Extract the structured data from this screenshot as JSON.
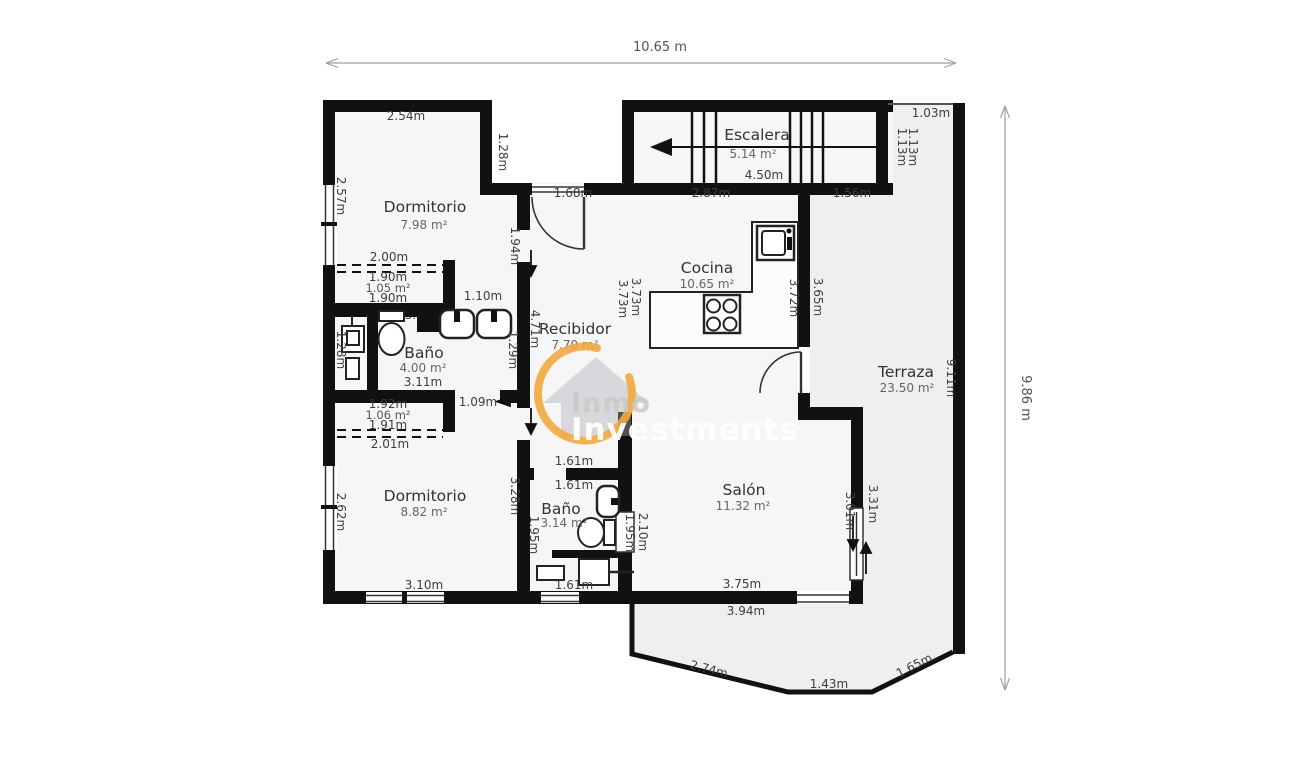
{
  "colors": {
    "wall": "#111111",
    "room_fill": "#f6f6f6",
    "terrace_fill": "#efefef",
    "watermark_orange": "#f3a93c",
    "dim_text": "#3d3d3d"
  },
  "overall": {
    "width_label": "10.65 m",
    "height_label": "9.86 m"
  },
  "watermark": {
    "brand_line1": "Inmo",
    "brand_line2": "Investments"
  },
  "rooms": {
    "dormitorio1": {
      "name": "Dormitorio",
      "area": "7.98 m²"
    },
    "armario1": {
      "area": "1.05 m²"
    },
    "banyo1": {
      "name": "Baño",
      "area": "4.00 m²"
    },
    "armario2": {
      "area": "1.06 m²"
    },
    "dormitorio2": {
      "name": "Dormitorio",
      "area": "8.82 m²"
    },
    "banyo2": {
      "name": "Baño",
      "area": "3.14 m²"
    },
    "recibidor": {
      "name": "Recibidor",
      "area": "7.70 m²"
    },
    "escalera": {
      "name": "Escalera",
      "area": "5.14 m²"
    },
    "cocina": {
      "name": "Cocina",
      "area": "10.65 m²"
    },
    "salon": {
      "name": "Salón",
      "area": "11.32 m²"
    },
    "terraza": {
      "name": "Terraza",
      "area": "23.50 m²"
    }
  },
  "dims": {
    "dorm1_top": "2.54m",
    "dorm1_step": "1.28m",
    "dorm1_left": "2.57m",
    "dorm1_right": "1.94m",
    "entry_door": "1.68m",
    "escalera_len": "4.50m",
    "notch_top": "1.03m",
    "notch_a": "1.13m",
    "notch_b": "1.13m",
    "cocina_top": "2.87m",
    "terraza_top": "1.56m",
    "armario1_top": "2.00m",
    "armario1_w1": "1.90m",
    "armario1_w2": "1.90m",
    "banyo1_door": "1.10m",
    "banyo1_top": "3.10m",
    "banyo1_bottom": "3.11m",
    "banyo1_left": "1.28m",
    "banyo1_right": "1.29m",
    "recibidor_left": "4.71m",
    "recibidor_a": "3.73m",
    "recibidor_b": "3.73m",
    "cocina_left": "3.72m",
    "cocina_right": "3.65m",
    "terraza_right": "9.11m",
    "armario2_top": "1.92m",
    "armario2_w": "1.91m",
    "armario2_bottom": "2.01m",
    "dorm2_door": "1.09m",
    "dorm2_left": "2.62m",
    "dorm2_right": "3.28m",
    "dorm2_bottom": "3.10m",
    "recibidor_bottom": "1.61m",
    "banyo2_top": "1.61m",
    "banyo2_left": "1.95m",
    "banyo2_right": "1.95m",
    "banyo2_bottom": "1.61m",
    "salon_left": "2.10m",
    "salon_bottom": "3.75m",
    "salon_bottom_out": "3.94m",
    "salon_door": "3.01m",
    "salon_right": "3.31m",
    "terraza_diag_l": "2.74m",
    "terraza_bottom": "1.43m",
    "terraza_diag_r": "1.65m"
  }
}
